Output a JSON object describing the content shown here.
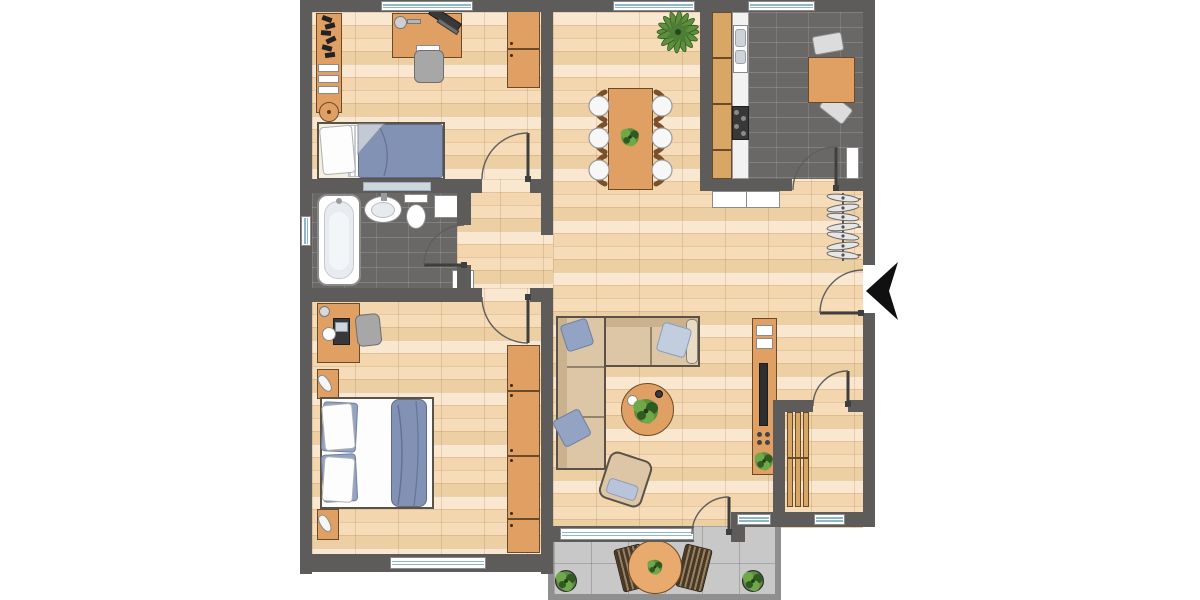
{
  "scene": "apartment-floor-plan",
  "rooms": {
    "office_bedroom": "office bedroom",
    "dining_area": "dining area",
    "kitchen": "kitchen",
    "bathroom": "bathroom",
    "master_bedroom": "master bedroom",
    "living_room": "living room",
    "hallway": "entrance hallway",
    "storage": "storage room",
    "terrace": "terrace"
  },
  "furniture": {
    "single_bed": "single bed",
    "double_bed": "double bed",
    "desk": "desk",
    "wardrobe": "wardrobe",
    "dining_table": "dining table for six",
    "kitchen_counter": "kitchen counter with sink and stove",
    "kitchen_table": "kitchen table",
    "bathtub": "bathtub",
    "washbasin": "washbasin",
    "toilet": "toilet",
    "corner_sofa": "corner sofa",
    "coffee_table": "round coffee table",
    "armchair": "armchair",
    "tv_sideboard": "tv sideboard",
    "coat_rack": "coat rack with hangers",
    "shelf": "slatted shelf",
    "terrace_set": "terrace table with two chairs"
  },
  "markers": {
    "entrance_arrow": "entry direction arrow"
  },
  "colors": {
    "wall": "#5e5c5a",
    "wood_base": "#f6dcb8",
    "wood_light": "#fae7cf",
    "wood_mid": "#f3d6ae",
    "wood_dark": "#eccfa2",
    "tile_dark": "#6a6867",
    "furniture": "#e0a064",
    "furniture_border": "#6b4a28",
    "counter_wood": "#d8a766",
    "window_glass": "#8fb8c6",
    "textile_blue": "#8292b5",
    "pillow_blue": "#93a3c4",
    "sofa_tan": "#dcc6a6",
    "sofa_edge": "#5a5248",
    "plant_green": "#5d8f3c",
    "plant_dark": "#2f5a22",
    "terrace_tile": "#c8c8c8",
    "terrace_edge": "#8f8f8f",
    "chair_gray": "#a7a7a7",
    "door_line": "#3f3f3f",
    "entry_arrow": "#101010"
  }
}
